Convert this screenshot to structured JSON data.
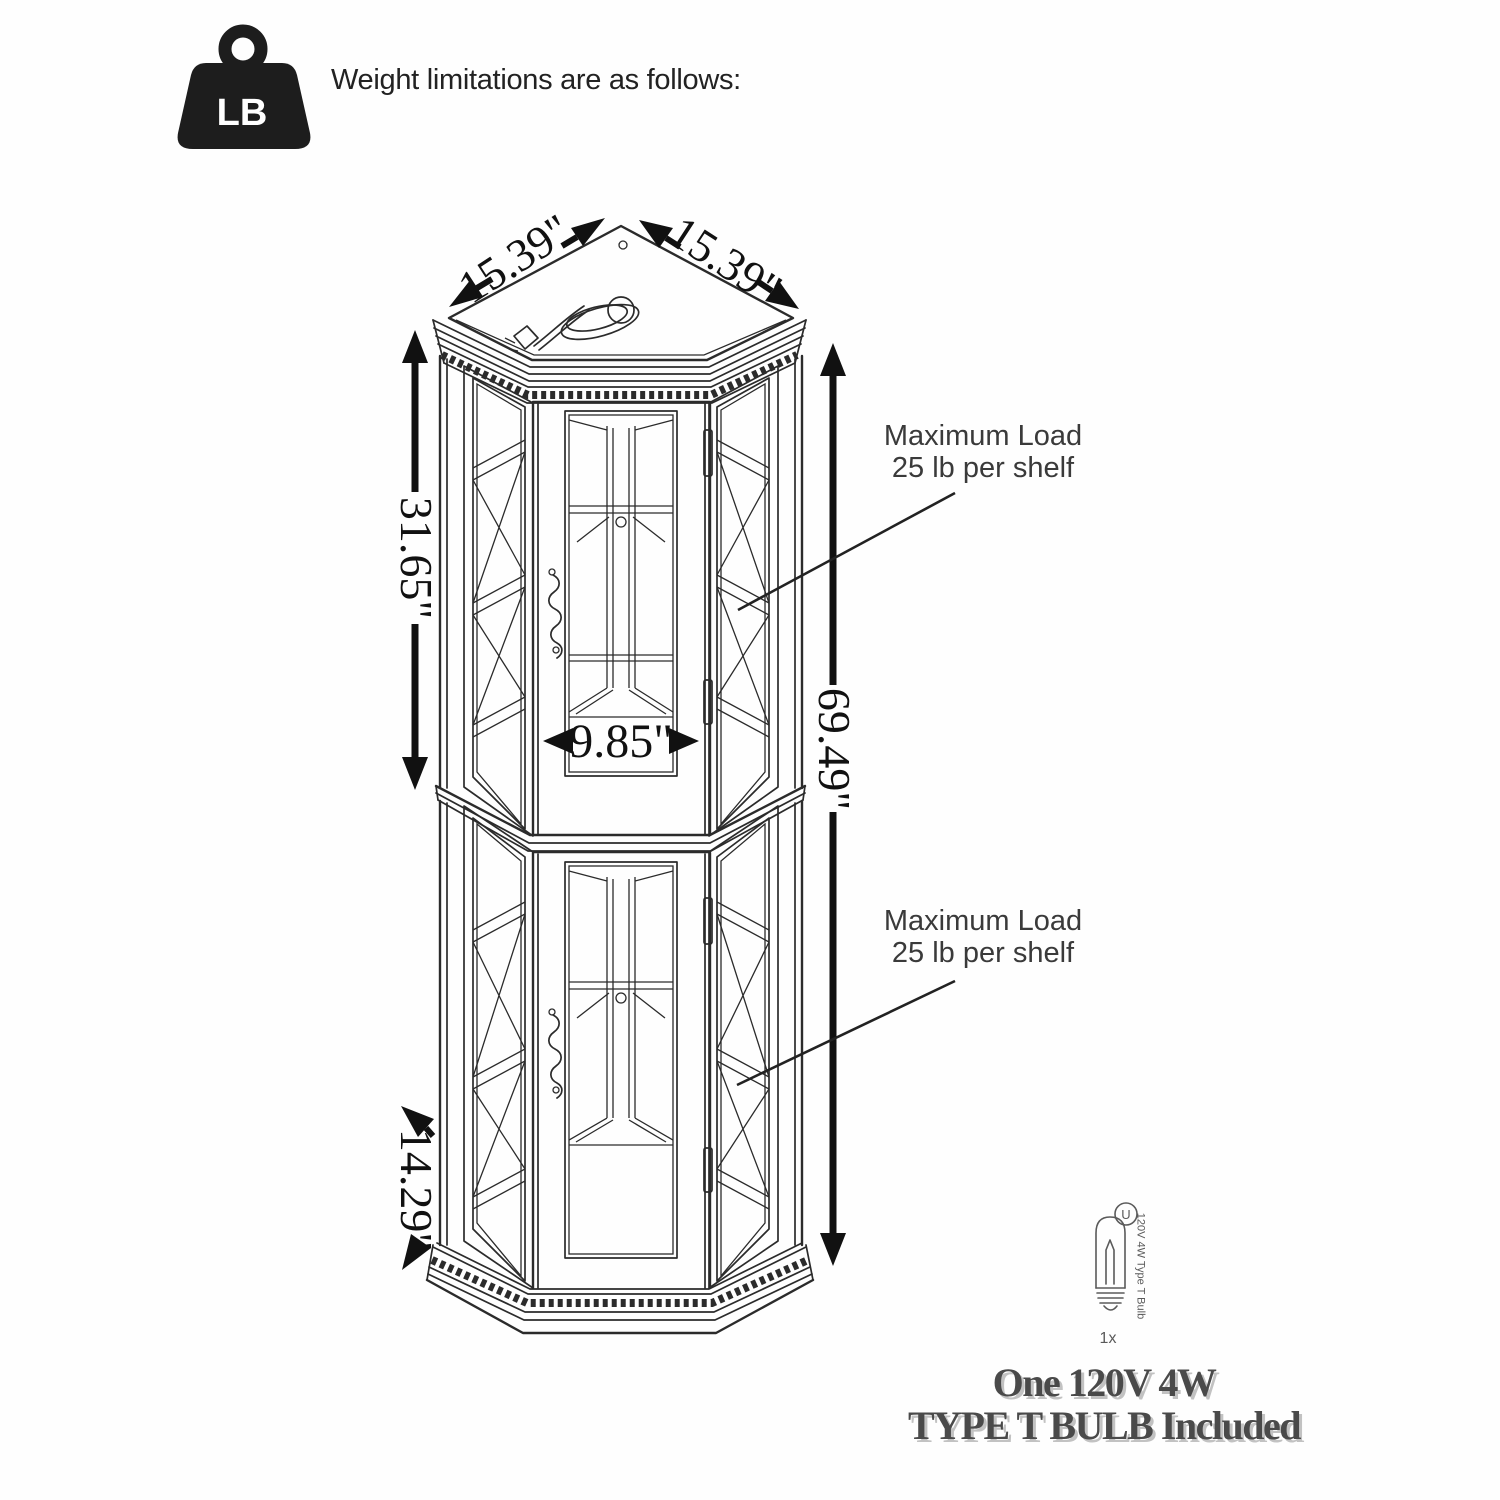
{
  "header": {
    "icon_label": "LB",
    "title": "Weight limitations are as follows:"
  },
  "dimensions": {
    "top_left_edge": "15.39\"",
    "top_right_edge": "15.39\"",
    "upper_section_height": "31.65\"",
    "interior_width": "9.85\"",
    "total_height": "69.49\"",
    "base_depth": "14.29\""
  },
  "annotations": {
    "upper": {
      "line1": "Maximum Load",
      "line2": "25 lb per shelf"
    },
    "lower": {
      "line1": "Maximum Load",
      "line2": "25 lb per shelf"
    }
  },
  "bulb": {
    "certification": "U",
    "label": "120V 4W Type T Bulb",
    "quantity": "1x"
  },
  "footer": {
    "line1": "One 120V 4W",
    "line2": "TYPE T BULB Included"
  },
  "colors": {
    "line": "#2b2b2b",
    "dim": "#111111",
    "annotation": "#3a3a3a",
    "bulb": "#5a5a5a",
    "footer": "#4a4a4a"
  }
}
